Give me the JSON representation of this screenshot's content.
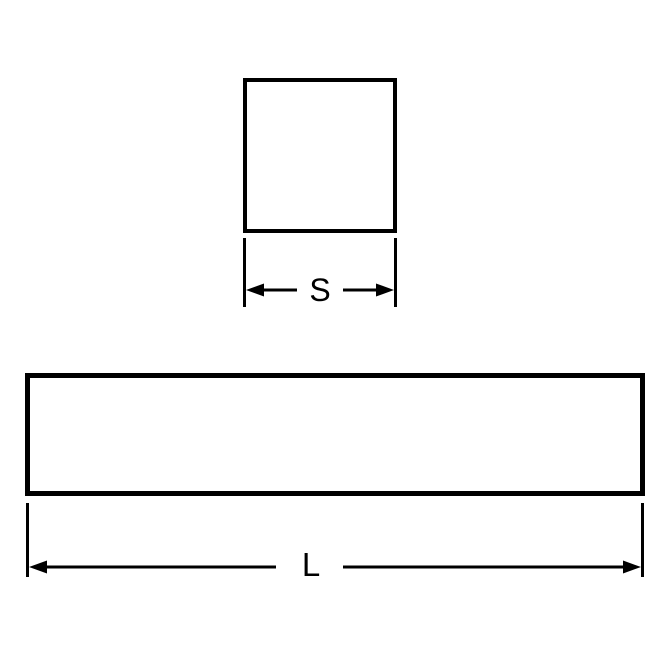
{
  "diagram": {
    "cross_section_label": "S",
    "length_label": "L",
    "colors": {
      "line": "#000000",
      "background": "#ffffff"
    }
  }
}
